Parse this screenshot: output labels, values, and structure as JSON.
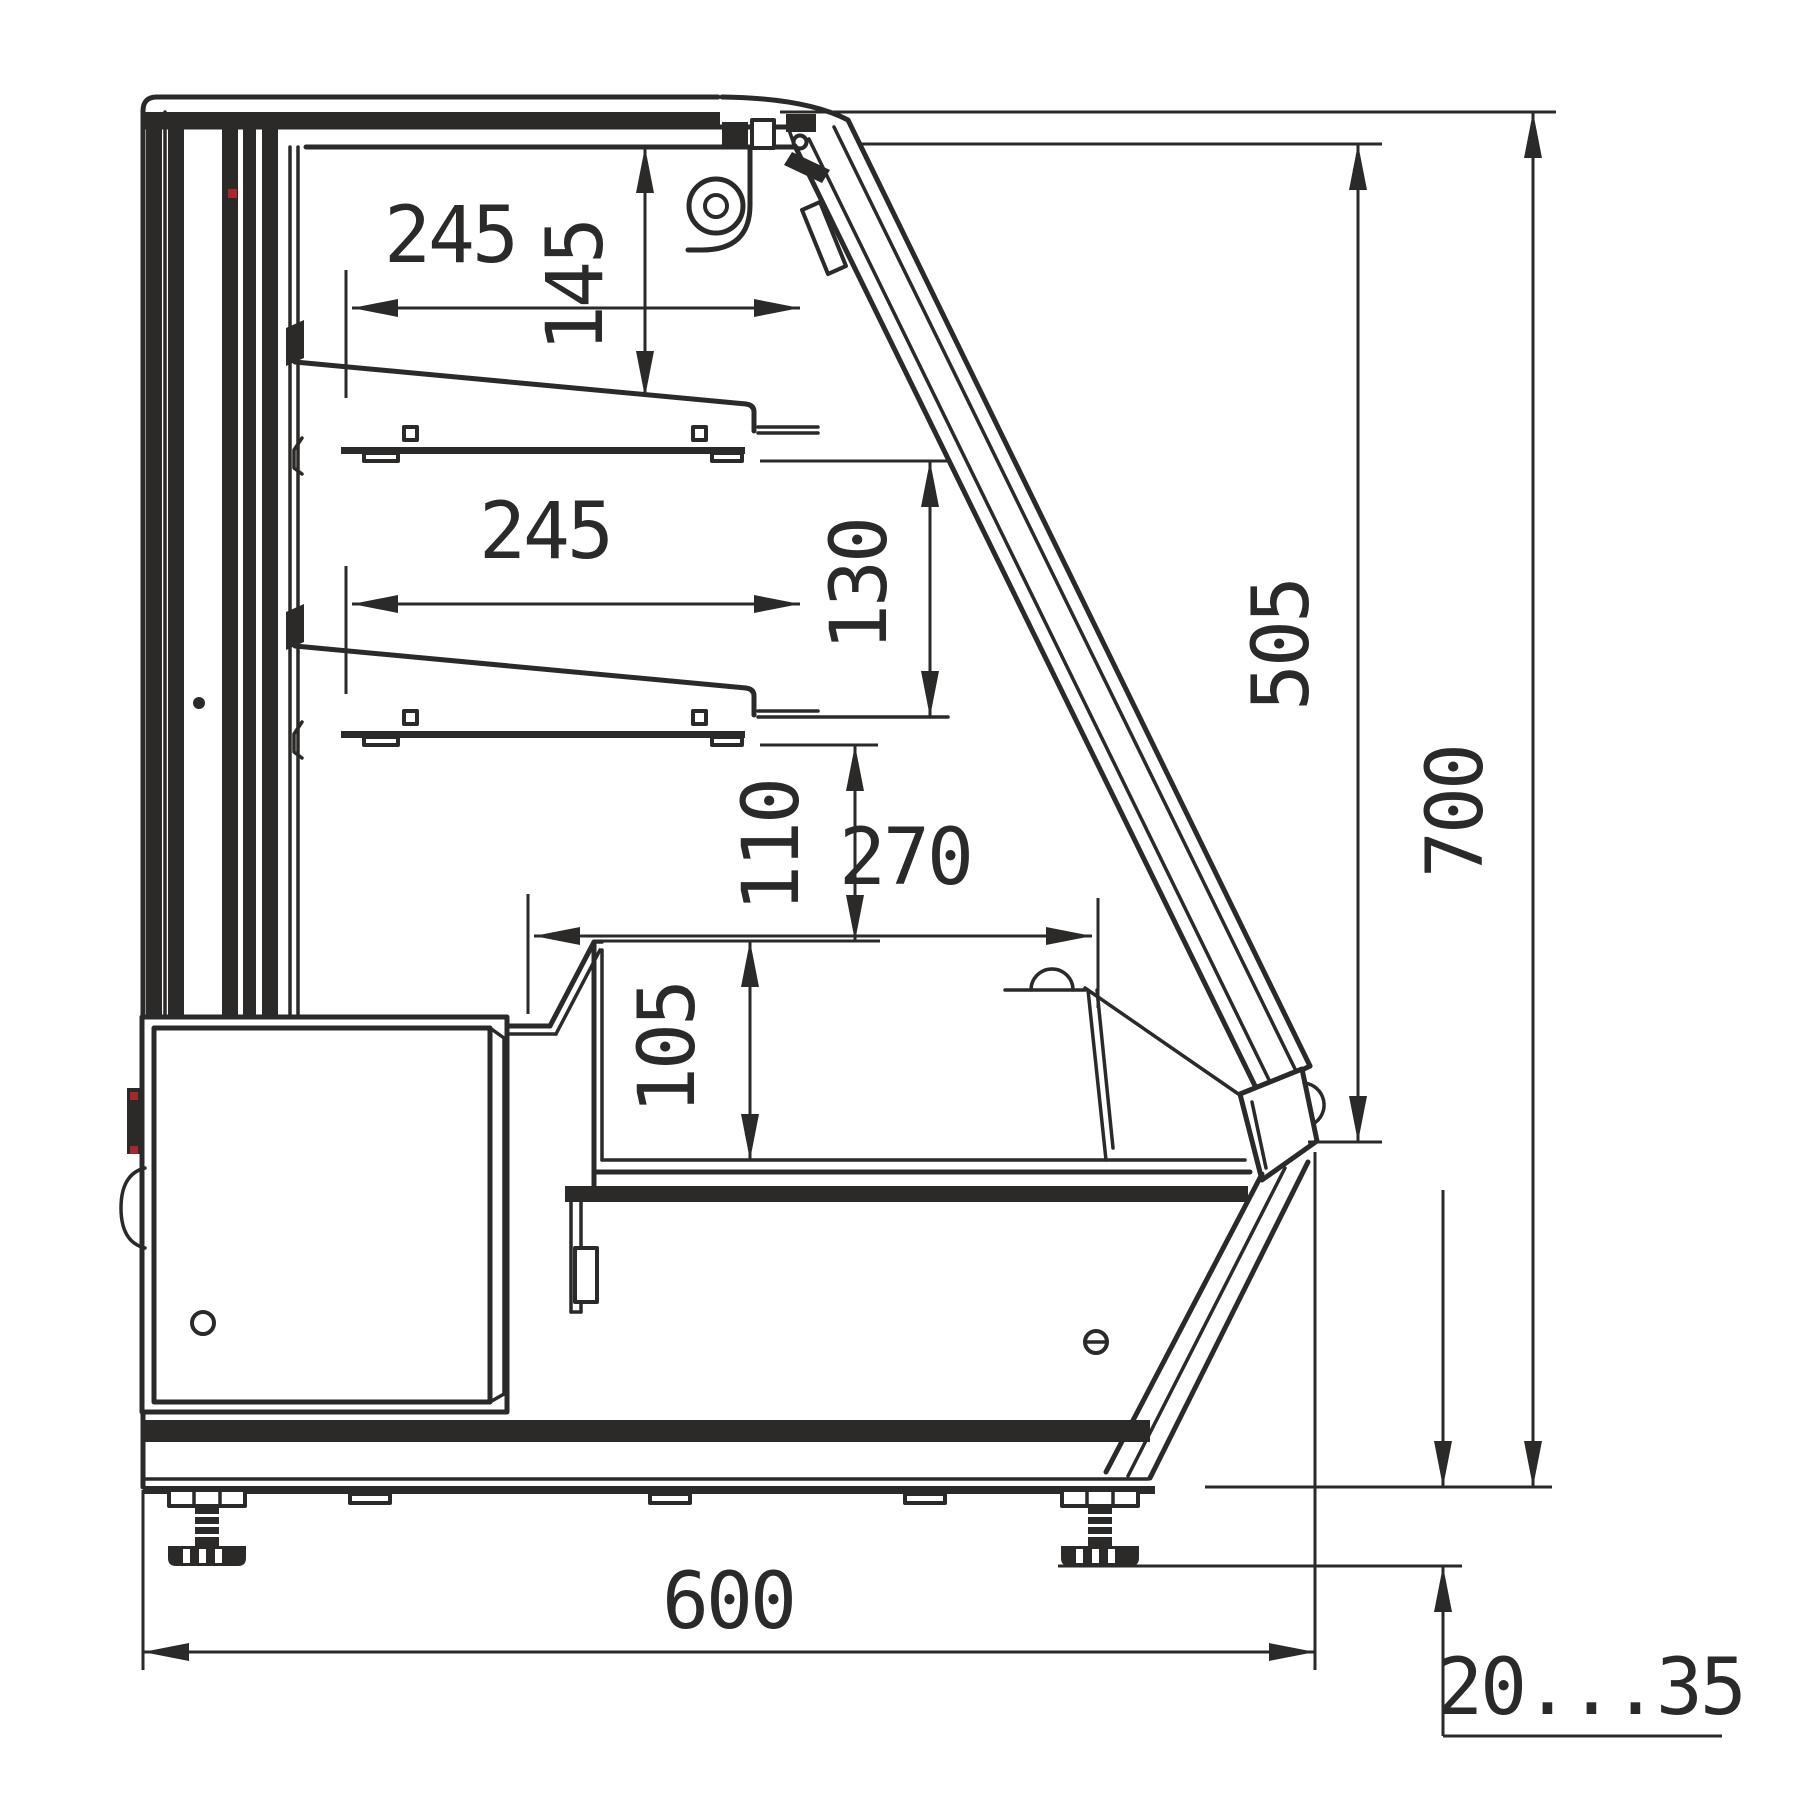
{
  "drawing": {
    "title": "refrigerated-display-case-side-section",
    "units": "mm",
    "line_color": "#2b2a29",
    "accent_color": "#a5282d",
    "dimensions": {
      "shelf_top_depth": "245",
      "top_clearance": "145",
      "shelf_mid_depth": "245",
      "mid_clearance": "130",
      "lower_clearance": "110",
      "well_depth": "270",
      "well_height": "105",
      "front_glass_height": "505",
      "total_height": "700",
      "total_depth": "600",
      "foot_adjust_range": "20...35"
    }
  }
}
